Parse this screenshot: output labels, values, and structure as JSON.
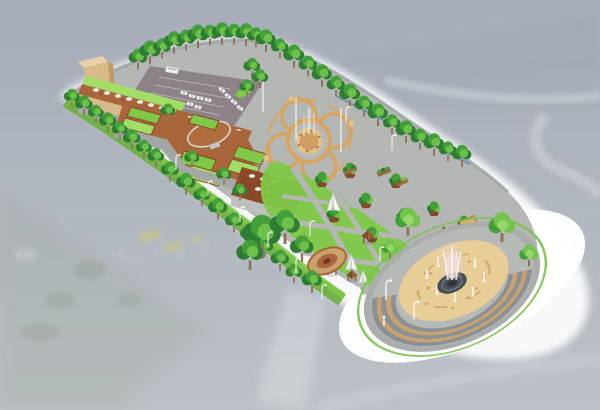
{
  "palette": {
    "bg_top": "#a7adb9",
    "bg_bottom": "#bcc1c6",
    "ridge": "#99a2b1",
    "bg_green": "#93a28c",
    "river": "#d2d7dc",
    "field_yellow": "#d8d253",
    "white": "#ffffff",
    "paving": "#b4b7b4",
    "edge_gray": "#9ba1a2",
    "parking": "#8e8289",
    "lawn": "#7fc848",
    "lawn_light": "#a2de66",
    "slope_green": "#6fb042",
    "tree_dark": "#2e7d32",
    "tree_mid": "#43a038",
    "tree_light": "#72c44d",
    "trunk": "#8a7355",
    "wall_tan": "#d8b98a",
    "wall_tan_light": "#e7d0a5",
    "wall_tan_shade": "#bd9a68",
    "wall_gray": "#bdc0bd",
    "wall_gray_shade": "#a4a8a5",
    "roof_brown": "#a9663a",
    "roof_dark": "#8a4a2a",
    "umbrella_white": "#f4f1e8",
    "plaza_band": "#d8a55e",
    "plaza_sand": "#e2c188",
    "plaza_sand_dark": "#cf9e62",
    "fountain_sand": "#e9cd96",
    "step_gray": "#8b9095",
    "bench_tan": "#c9a36b",
    "basin_dark": "#4b5157",
    "spray_pink": "#eed3da",
    "fence_blue": "#4a7fae",
    "ring_green": "#77c24c"
  },
  "scene": {
    "elements": [
      "aerial-photo-background",
      "mountain-ridge",
      "river",
      "village-fields",
      "park-platform",
      "white-apron",
      "parking-lot",
      "cars",
      "shuttle-bus",
      "tan-tower-building",
      "roof-terrace-with-umbrellas",
      "green-roof-gardens",
      "circular-roof-terrace",
      "cafe-building",
      "quatrefoil-fountain-plaza",
      "tree-lined-edges",
      "perimeter-fence",
      "garden-lawn-cells",
      "tree-planters",
      "gazebos",
      "shade-canopies",
      "small-circular-garden",
      "shrub-planters",
      "pergola",
      "grand-fountain-plaza",
      "amphitheater-steps",
      "central-fountain",
      "water-jets",
      "light-poles",
      "pedestrian"
    ]
  }
}
